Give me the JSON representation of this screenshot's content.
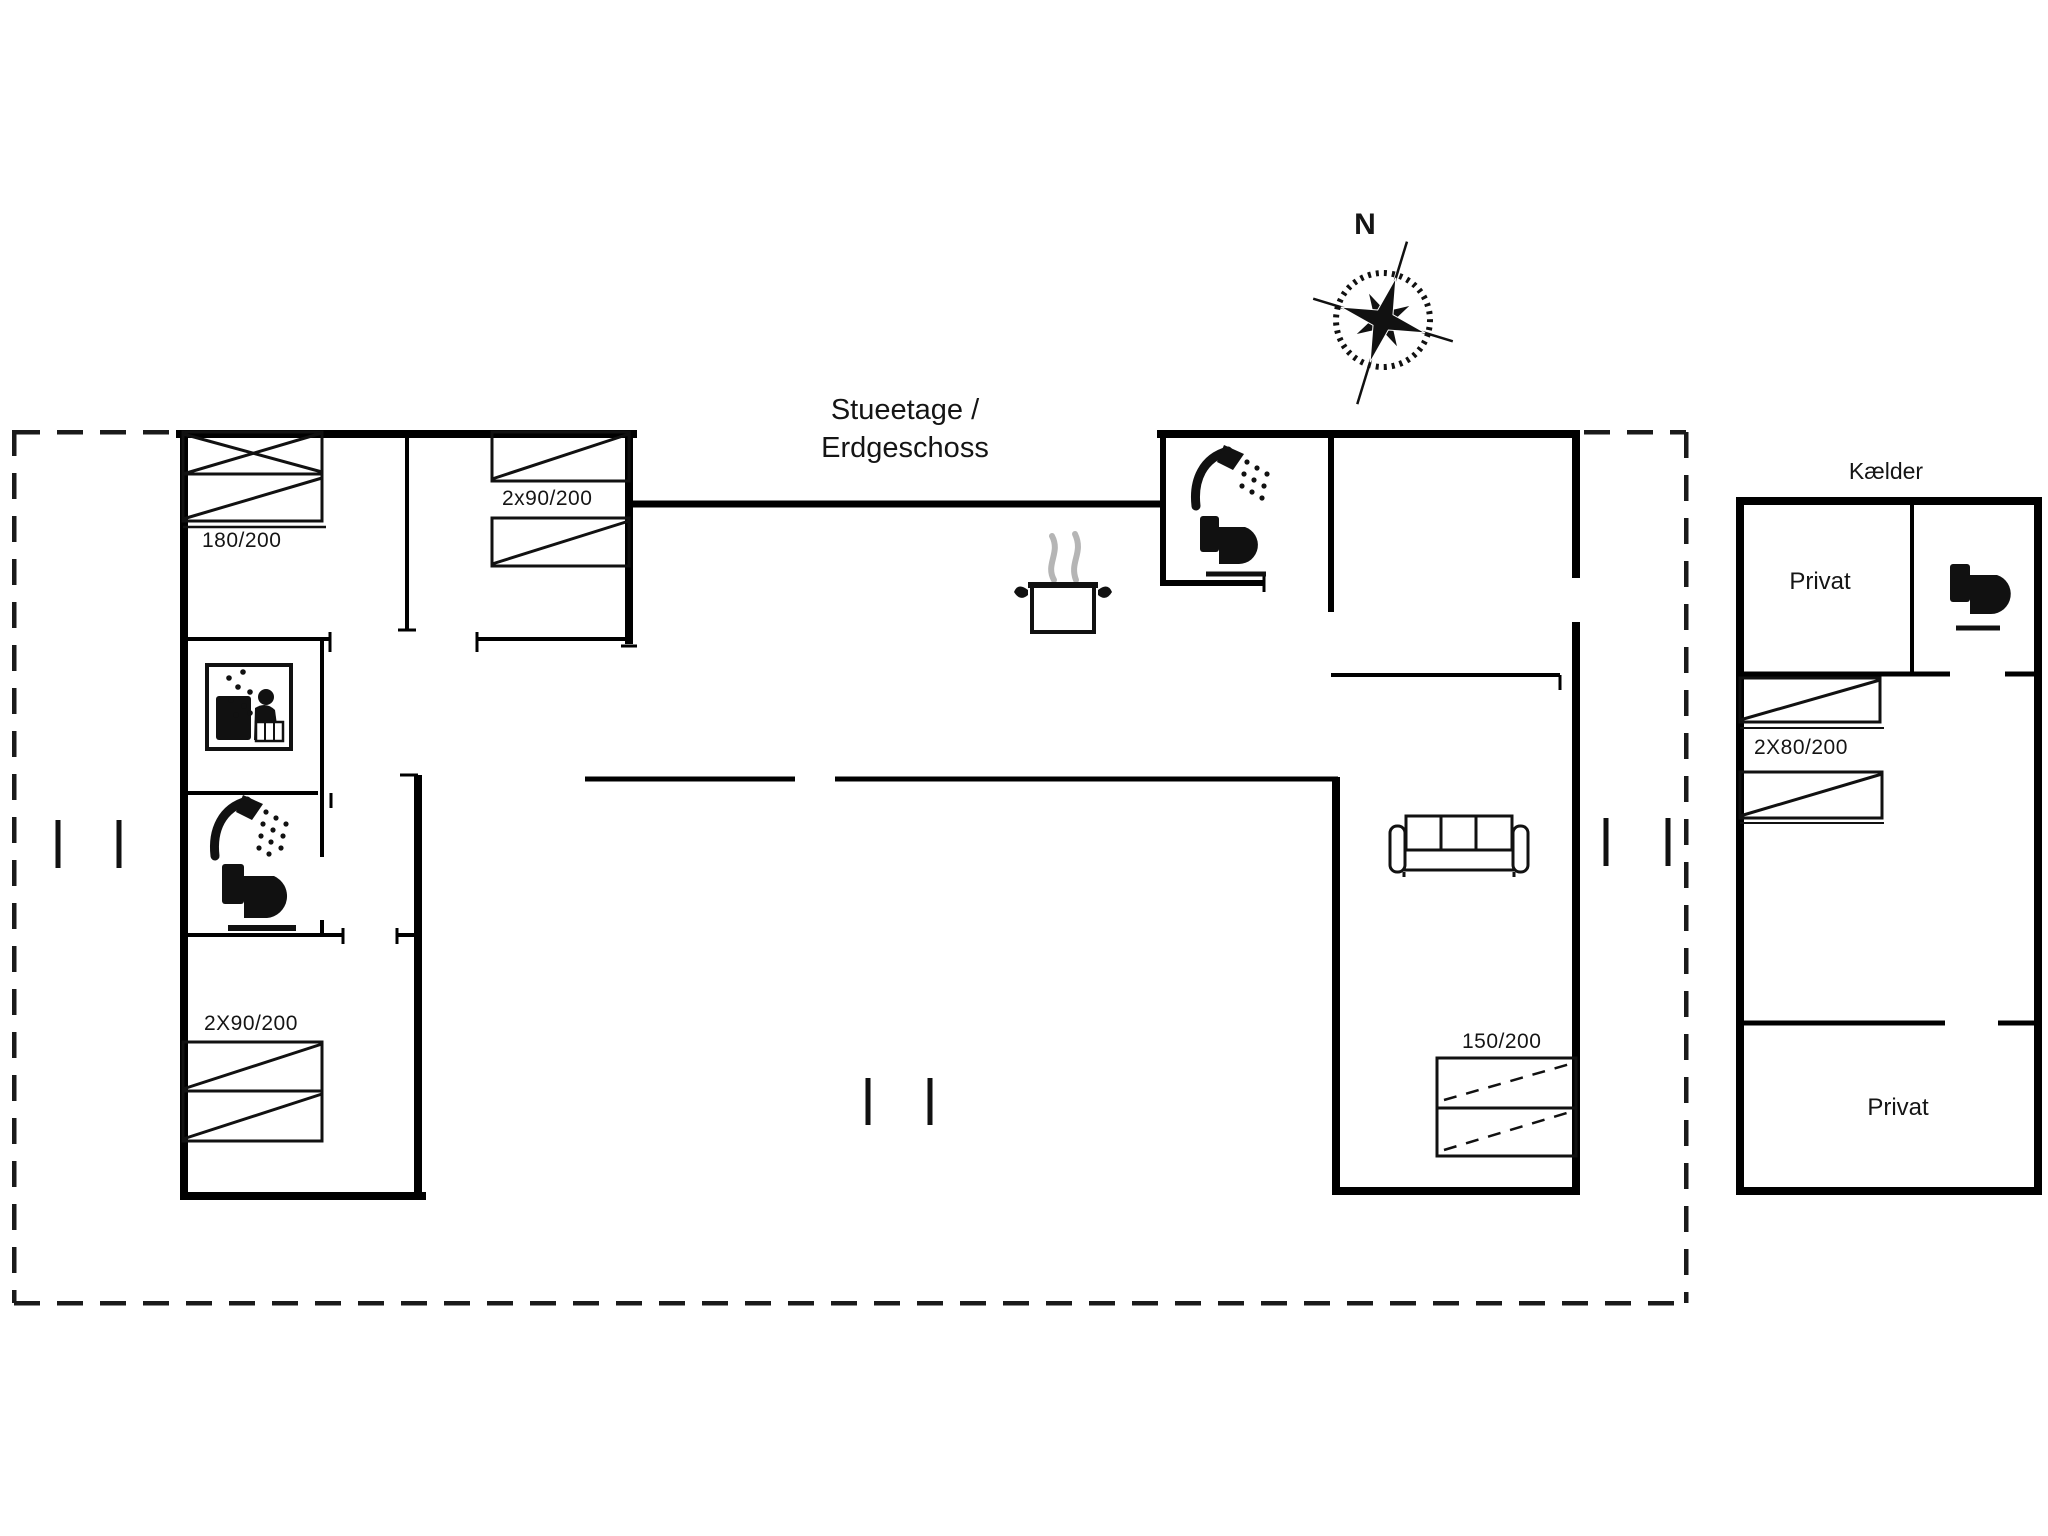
{
  "colors": {
    "ink": "#000000",
    "steam": "#b5b5b5"
  },
  "compass": {
    "north_label": "N"
  },
  "floor_title": {
    "line1": "Stueetage /",
    "line2": "Erdgeschoss"
  },
  "ground_floor": {
    "bed_labels": {
      "double_bed": "180/200",
      "twin_beds_top": "2x90/200",
      "twin_beds_left": "2X90/200",
      "double_bed_right": "150/200"
    },
    "icons": [
      "washing-machine-icon",
      "shower-icon",
      "toilet-icon",
      "cooking-pot-icon",
      "shower-icon",
      "toilet-icon",
      "sofa-icon"
    ]
  },
  "basement": {
    "title": "Kælder",
    "private_room_top": "Privat",
    "private_room_bottom": "Privat",
    "bed_label": "2X80/200",
    "icons": [
      "toilet-icon"
    ]
  }
}
